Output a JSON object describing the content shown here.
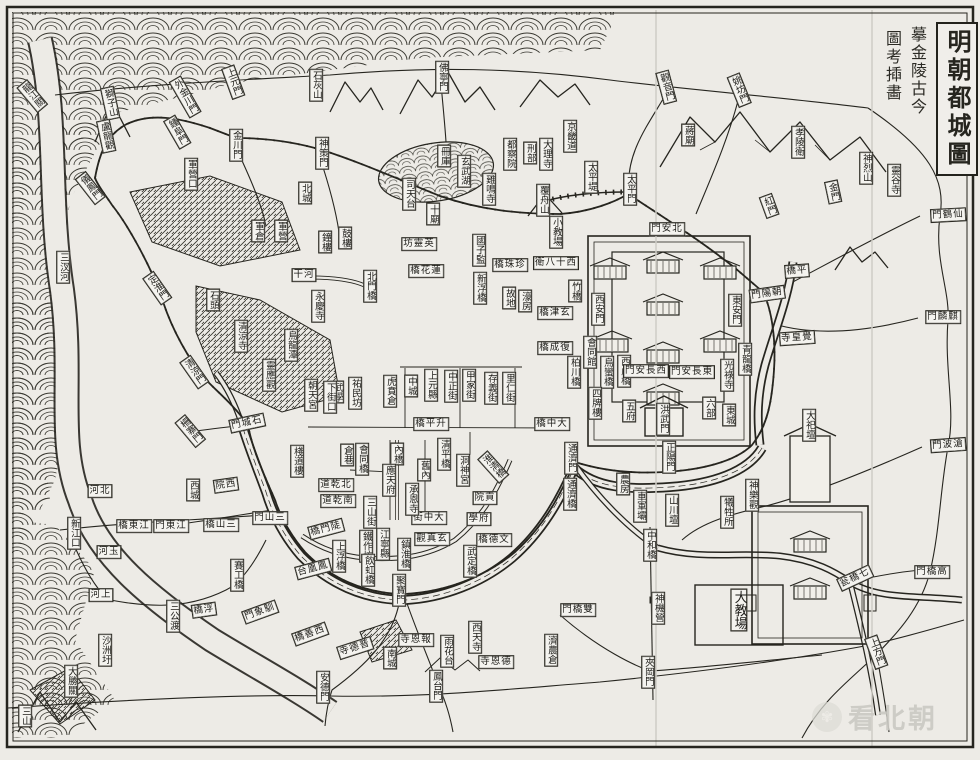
{
  "canvas": {
    "width": 980,
    "height": 760,
    "paper_color": "#edebe6",
    "ink_color": "#26251f",
    "label_bg": "#f4f3ef"
  },
  "title": {
    "main": "明朝都城圖",
    "note_right": "摹金陵古今",
    "note_left": "圖考揷畵"
  },
  "watermark": {
    "brand": "看北朝",
    "badge_icon": "hand-logo"
  },
  "labels": [
    {
      "t": "龍江關",
      "x": 32,
      "y": 96,
      "o": "v",
      "r": -40
    },
    {
      "t": "獅子山",
      "x": 110,
      "y": 103,
      "o": "v",
      "r": -12
    },
    {
      "t": "盧龍觀",
      "x": 106,
      "y": 136,
      "o": "v",
      "r": -12
    },
    {
      "t": "外金川門",
      "x": 185,
      "y": 97,
      "o": "v",
      "r": -30
    },
    {
      "t": "鍾阜門",
      "x": 177,
      "y": 132,
      "o": "v",
      "r": -30
    },
    {
      "t": "儀鳳門",
      "x": 90,
      "y": 188,
      "o": "v",
      "r": -38
    },
    {
      "t": "上元門",
      "x": 233,
      "y": 82,
      "o": "v",
      "r": -20
    },
    {
      "t": "金川門",
      "x": 236,
      "y": 145,
      "o": "v",
      "r": 0
    },
    {
      "t": "軍營口",
      "x": 191,
      "y": 174,
      "o": "v",
      "r": 0
    },
    {
      "t": "石灰山",
      "x": 316,
      "y": 85,
      "o": "v",
      "r": 0
    },
    {
      "t": "神策門",
      "x": 322,
      "y": 153,
      "o": "v",
      "r": 0
    },
    {
      "t": "佛寧門",
      "x": 442,
      "y": 77,
      "o": "v",
      "r": 0
    },
    {
      "t": "觀音門",
      "x": 666,
      "y": 87,
      "o": "v",
      "r": -15
    },
    {
      "t": "姚坊門",
      "x": 739,
      "y": 90,
      "o": "v",
      "r": -22
    },
    {
      "t": "蔣廟",
      "x": 688,
      "y": 135,
      "o": "v",
      "r": 0
    },
    {
      "t": "孝陵衛",
      "x": 798,
      "y": 142,
      "o": "v",
      "r": 0
    },
    {
      "t": "神烈山",
      "x": 866,
      "y": 168,
      "o": "v",
      "r": 0
    },
    {
      "t": "靈谷寺",
      "x": 894,
      "y": 180,
      "o": "v",
      "r": 0
    },
    {
      "t": "金門",
      "x": 833,
      "y": 192,
      "o": "v",
      "r": -12
    },
    {
      "t": "紅門",
      "x": 769,
      "y": 206,
      "o": "v",
      "r": -20
    },
    {
      "t": "太平門",
      "x": 630,
      "y": 189,
      "o": "v",
      "r": 0
    },
    {
      "t": "太平堤",
      "x": 591,
      "y": 177,
      "o": "v",
      "r": 0
    },
    {
      "t": "門鶴仙",
      "x": 948,
      "y": 215,
      "o": "h",
      "r": -3
    },
    {
      "t": "門麟麒",
      "x": 943,
      "y": 317,
      "o": "h",
      "r": 0
    },
    {
      "t": "門波滄",
      "x": 948,
      "y": 445,
      "o": "h",
      "r": -4
    },
    {
      "t": "北城",
      "x": 305,
      "y": 193,
      "o": "v",
      "r": 0
    },
    {
      "t": "軍倉",
      "x": 258,
      "y": 231,
      "o": "v",
      "r": 0
    },
    {
      "t": "軍營",
      "x": 281,
      "y": 231,
      "o": "v",
      "r": 0
    },
    {
      "t": "鐘樓",
      "x": 325,
      "y": 242,
      "o": "v",
      "r": 0
    },
    {
      "t": "鼓樓",
      "x": 345,
      "y": 238,
      "o": "v",
      "r": 0
    },
    {
      "t": "冊庫",
      "x": 444,
      "y": 156,
      "o": "v",
      "r": 0
    },
    {
      "t": "玄武湖",
      "x": 464,
      "y": 171,
      "o": "v",
      "r": 0
    },
    {
      "t": "司天台",
      "x": 409,
      "y": 194,
      "o": "v",
      "r": 0
    },
    {
      "t": "十廟",
      "x": 433,
      "y": 214,
      "o": "v",
      "r": 0
    },
    {
      "t": "雞鳴寺",
      "x": 489,
      "y": 189,
      "o": "v",
      "r": 0
    },
    {
      "t": "覆舟山",
      "x": 543,
      "y": 200,
      "o": "v",
      "r": 0
    },
    {
      "t": "京畿道",
      "x": 570,
      "y": 136,
      "o": "v",
      "r": 0
    },
    {
      "t": "都察院",
      "x": 510,
      "y": 154,
      "o": "v",
      "r": 0
    },
    {
      "t": "刑部",
      "x": 530,
      "y": 153,
      "o": "v",
      "r": 0
    },
    {
      "t": "大理寺",
      "x": 546,
      "y": 154,
      "o": "v",
      "r": 0
    },
    {
      "t": "小教場",
      "x": 556,
      "y": 232,
      "o": "v",
      "r": 0
    },
    {
      "t": "國子監",
      "x": 479,
      "y": 250,
      "o": "v",
      "r": 0
    },
    {
      "t": "坊靈英",
      "x": 419,
      "y": 244,
      "o": "h",
      "r": 0
    },
    {
      "t": "橋珠珍",
      "x": 510,
      "y": 265,
      "o": "h",
      "r": 0
    },
    {
      "t": "衛八十西",
      "x": 556,
      "y": 263,
      "o": "h",
      "r": 0
    },
    {
      "t": "橋花蓮",
      "x": 426,
      "y": 271,
      "o": "h",
      "r": 0
    },
    {
      "t": "新浮橋",
      "x": 480,
      "y": 288,
      "o": "v",
      "r": 0
    },
    {
      "t": "竹橋",
      "x": 575,
      "y": 291,
      "o": "v",
      "r": 0
    },
    {
      "t": "故地",
      "x": 509,
      "y": 298,
      "o": "v",
      "r": 0
    },
    {
      "t": "濠房",
      "x": 525,
      "y": 301,
      "o": "v",
      "r": 0
    },
    {
      "t": "橋津玄",
      "x": 555,
      "y": 313,
      "o": "h",
      "r": 0
    },
    {
      "t": "干河",
      "x": 304,
      "y": 275,
      "o": "h",
      "r": 0
    },
    {
      "t": "永慶寺",
      "x": 318,
      "y": 306,
      "o": "v",
      "r": 0
    },
    {
      "t": "北門橋",
      "x": 370,
      "y": 286,
      "o": "v",
      "r": 0
    },
    {
      "t": "定淮門",
      "x": 157,
      "y": 288,
      "o": "v",
      "r": -35
    },
    {
      "t": "石頭",
      "x": 213,
      "y": 300,
      "o": "v",
      "r": 0
    },
    {
      "t": "清涼寺",
      "x": 241,
      "y": 336,
      "o": "v",
      "r": 0
    },
    {
      "t": "烏龍潭",
      "x": 291,
      "y": 345,
      "o": "v",
      "r": 0
    },
    {
      "t": "靈應觀",
      "x": 269,
      "y": 375,
      "o": "v",
      "r": 0
    },
    {
      "t": "清涼門",
      "x": 194,
      "y": 372,
      "o": "v",
      "r": -35
    },
    {
      "t": "武學",
      "x": 337,
      "y": 392,
      "o": "v",
      "r": 0
    },
    {
      "t": "祐民坊",
      "x": 355,
      "y": 393,
      "o": "v",
      "r": 0
    },
    {
      "t": "虎賁倉",
      "x": 390,
      "y": 391,
      "o": "v",
      "r": 0
    },
    {
      "t": "朝天宮",
      "x": 311,
      "y": 395,
      "o": "v",
      "r": 0
    },
    {
      "t": "下街口",
      "x": 330,
      "y": 397,
      "o": "v",
      "r": 0
    },
    {
      "t": "門城石",
      "x": 247,
      "y": 423,
      "o": "h",
      "r": -12
    },
    {
      "t": "柵寨門",
      "x": 190,
      "y": 431,
      "o": "v",
      "r": -40
    },
    {
      "t": "西城",
      "x": 193,
      "y": 490,
      "o": "v",
      "r": 0
    },
    {
      "t": "院西",
      "x": 226,
      "y": 485,
      "o": "h",
      "r": -8
    },
    {
      "t": "倉巷",
      "x": 347,
      "y": 455,
      "o": "v",
      "r": 0
    },
    {
      "t": "棧道樓",
      "x": 297,
      "y": 461,
      "o": "v",
      "r": 0
    },
    {
      "t": "橋平升",
      "x": 431,
      "y": 424,
      "o": "h",
      "r": 0
    },
    {
      "t": "橋中大",
      "x": 552,
      "y": 424,
      "o": "h",
      "r": 0
    },
    {
      "t": "中城",
      "x": 411,
      "y": 386,
      "o": "v",
      "r": 0
    },
    {
      "t": "上元縣",
      "x": 431,
      "y": 385,
      "o": "v",
      "r": 0
    },
    {
      "t": "中正街",
      "x": 451,
      "y": 386,
      "o": "v",
      "r": 0
    },
    {
      "t": "甲家街",
      "x": 469,
      "y": 385,
      "o": "v",
      "r": 0
    },
    {
      "t": "存義街",
      "x": 491,
      "y": 388,
      "o": "v",
      "r": 0
    },
    {
      "t": "里仁街",
      "x": 509,
      "y": 388,
      "o": "v",
      "r": 0
    },
    {
      "t": "橋成復",
      "x": 555,
      "y": 348,
      "o": "h",
      "r": 0
    },
    {
      "t": "會同館",
      "x": 590,
      "y": 352,
      "o": "v",
      "r": 0
    },
    {
      "t": "柏川橋",
      "x": 574,
      "y": 372,
      "o": "v",
      "r": 0
    },
    {
      "t": "烏蠻橋",
      "x": 607,
      "y": 372,
      "o": "v",
      "r": 0
    },
    {
      "t": "四牌樓",
      "x": 595,
      "y": 403,
      "o": "v",
      "r": 0
    },
    {
      "t": "西虎橋",
      "x": 624,
      "y": 371,
      "o": "v",
      "r": 0
    },
    {
      "t": "門安長西",
      "x": 646,
      "y": 371,
      "o": "h",
      "r": 0
    },
    {
      "t": "門安長東",
      "x": 692,
      "y": 372,
      "o": "h",
      "r": 0
    },
    {
      "t": "五府",
      "x": 629,
      "y": 411,
      "o": "v",
      "r": 0
    },
    {
      "t": "六部",
      "x": 709,
      "y": 408,
      "o": "v",
      "r": 0
    },
    {
      "t": "東城",
      "x": 729,
      "y": 415,
      "o": "v",
      "r": 0
    },
    {
      "t": "洪武門",
      "x": 663,
      "y": 419,
      "o": "v",
      "r": 0
    },
    {
      "t": "光祿寺",
      "x": 727,
      "y": 375,
      "o": "v",
      "r": 0
    },
    {
      "t": "青龍橋",
      "x": 745,
      "y": 359,
      "o": "v",
      "r": 0
    },
    {
      "t": "門安北",
      "x": 667,
      "y": 229,
      "o": "h",
      "r": 0
    },
    {
      "t": "西安門",
      "x": 598,
      "y": 309,
      "o": "v",
      "r": 0
    },
    {
      "t": "東安門",
      "x": 735,
      "y": 310,
      "o": "v",
      "r": 0
    },
    {
      "t": "門陽朝",
      "x": 767,
      "y": 294,
      "o": "h",
      "r": -8
    },
    {
      "t": "橋平",
      "x": 797,
      "y": 271,
      "o": "h",
      "r": -4
    },
    {
      "t": "寺皇覺",
      "x": 797,
      "y": 338,
      "o": "h",
      "r": -4
    },
    {
      "t": "內橋",
      "x": 397,
      "y": 454,
      "o": "v",
      "r": 0
    },
    {
      "t": "會同橋",
      "x": 362,
      "y": 459,
      "o": "v",
      "r": 0
    },
    {
      "t": "應天府",
      "x": 389,
      "y": 480,
      "o": "v",
      "r": 0
    },
    {
      "t": "舊內",
      "x": 424,
      "y": 470,
      "o": "v",
      "r": 0
    },
    {
      "t": "清平橋",
      "x": 444,
      "y": 454,
      "o": "v",
      "r": 0
    },
    {
      "t": "洞神宮",
      "x": 463,
      "y": 470,
      "o": "v",
      "r": 0
    },
    {
      "t": "淮清橋",
      "x": 493,
      "y": 467,
      "o": "v",
      "r": -42
    },
    {
      "t": "道乾北",
      "x": 336,
      "y": 485,
      "o": "h",
      "r": 0
    },
    {
      "t": "道乾南",
      "x": 338,
      "y": 501,
      "o": "h",
      "r": 0
    },
    {
      "t": "街中大",
      "x": 429,
      "y": 518,
      "o": "h",
      "r": 0
    },
    {
      "t": "承恩寺",
      "x": 412,
      "y": 499,
      "o": "v",
      "r": 0
    },
    {
      "t": "觀真玄",
      "x": 432,
      "y": 539,
      "o": "h",
      "r": 0
    },
    {
      "t": "院貢",
      "x": 485,
      "y": 498,
      "o": "h",
      "r": 0
    },
    {
      "t": "學府",
      "x": 479,
      "y": 519,
      "o": "h",
      "r": 0
    },
    {
      "t": "橋德文",
      "x": 494,
      "y": 540,
      "o": "h",
      "r": 0
    },
    {
      "t": "武定橋",
      "x": 470,
      "y": 561,
      "o": "v",
      "r": 0
    },
    {
      "t": "三山街",
      "x": 370,
      "y": 512,
      "o": "v",
      "r": 0
    },
    {
      "t": "江寧縣",
      "x": 383,
      "y": 544,
      "o": "v",
      "r": 0
    },
    {
      "t": "鐵作坊",
      "x": 366,
      "y": 546,
      "o": "v",
      "r": 0
    },
    {
      "t": "飲虹橋",
      "x": 368,
      "y": 570,
      "o": "v",
      "r": 0
    },
    {
      "t": "鎮淮橋",
      "x": 404,
      "y": 554,
      "o": "v",
      "r": 0
    },
    {
      "t": "聚寶門",
      "x": 399,
      "y": 590,
      "o": "v",
      "r": 0
    },
    {
      "t": "上浮橋",
      "x": 339,
      "y": 556,
      "o": "v",
      "r": 0
    },
    {
      "t": "橋門陡",
      "x": 326,
      "y": 529,
      "o": "h",
      "r": -15
    },
    {
      "t": "台凰鳳",
      "x": 313,
      "y": 569,
      "o": "h",
      "r": -15
    },
    {
      "t": "通濟門",
      "x": 571,
      "y": 458,
      "o": "v",
      "r": 0
    },
    {
      "t": "通濟橋",
      "x": 570,
      "y": 494,
      "o": "v",
      "r": 0
    },
    {
      "t": "正陽門",
      "x": 669,
      "y": 457,
      "o": "v",
      "r": 0
    },
    {
      "t": "農房",
      "x": 623,
      "y": 484,
      "o": "v",
      "r": 0
    },
    {
      "t": "車軍壩",
      "x": 640,
      "y": 506,
      "o": "v",
      "r": 0
    },
    {
      "t": "山川壇",
      "x": 672,
      "y": 510,
      "o": "v",
      "r": 0
    },
    {
      "t": "犧牲所",
      "x": 727,
      "y": 512,
      "o": "v",
      "r": 0
    },
    {
      "t": "神樂觀",
      "x": 752,
      "y": 495,
      "o": "v",
      "r": 0
    },
    {
      "t": "大祀壇",
      "x": 809,
      "y": 425,
      "o": "v",
      "r": 0
    },
    {
      "t": "中和橋",
      "x": 650,
      "y": 545,
      "o": "v",
      "r": 0
    },
    {
      "t": "神機營",
      "x": 658,
      "y": 608,
      "o": "v",
      "r": 0
    },
    {
      "t": "大教場",
      "x": 739,
      "y": 610,
      "o": "v",
      "r": 0,
      "s": 13
    },
    {
      "t": "門橋雙",
      "x": 578,
      "y": 610,
      "o": "h",
      "r": 0
    },
    {
      "t": "濟農倉",
      "x": 551,
      "y": 650,
      "o": "v",
      "r": 0
    },
    {
      "t": "夾岡門",
      "x": 648,
      "y": 672,
      "o": "v",
      "r": 0
    },
    {
      "t": "上方門",
      "x": 876,
      "y": 652,
      "o": "v",
      "r": -20
    },
    {
      "t": "門橋高",
      "x": 932,
      "y": 572,
      "o": "h",
      "r": 0
    },
    {
      "t": "瓮橋七",
      "x": 855,
      "y": 578,
      "o": "h",
      "r": -25
    },
    {
      "t": "寺恩報",
      "x": 416,
      "y": 640,
      "o": "h",
      "r": 0
    },
    {
      "t": "雨花台",
      "x": 447,
      "y": 651,
      "o": "v",
      "r": 0
    },
    {
      "t": "西天寺",
      "x": 475,
      "y": 637,
      "o": "v",
      "r": 0
    },
    {
      "t": "寺恩德",
      "x": 496,
      "y": 662,
      "o": "h",
      "r": 0
    },
    {
      "t": "南城",
      "x": 390,
      "y": 658,
      "o": "v",
      "r": 0
    },
    {
      "t": "鳳台門",
      "x": 436,
      "y": 686,
      "o": "v",
      "r": 0
    },
    {
      "t": "安德門",
      "x": 323,
      "y": 687,
      "o": "v",
      "r": 0
    },
    {
      "t": "門象馴",
      "x": 260,
      "y": 612,
      "o": "h",
      "r": -20
    },
    {
      "t": "橋善西",
      "x": 310,
      "y": 634,
      "o": "h",
      "r": -20
    },
    {
      "t": "寺德普",
      "x": 355,
      "y": 648,
      "o": "h",
      "r": -18
    },
    {
      "t": "三汊河",
      "x": 63,
      "y": 267,
      "o": "v",
      "r": 0
    },
    {
      "t": "河北",
      "x": 100,
      "y": 491,
      "o": "h",
      "r": 0
    },
    {
      "t": "新江口",
      "x": 74,
      "y": 533,
      "o": "v",
      "r": 0
    },
    {
      "t": "河玉",
      "x": 109,
      "y": 552,
      "o": "h",
      "r": 0
    },
    {
      "t": "河上",
      "x": 101,
      "y": 595,
      "o": "h",
      "r": 0
    },
    {
      "t": "橋東江",
      "x": 134,
      "y": 526,
      "o": "h",
      "r": 0
    },
    {
      "t": "門東江",
      "x": 171,
      "y": 526,
      "o": "h",
      "r": 0
    },
    {
      "t": "橋山三",
      "x": 221,
      "y": 525,
      "o": "h",
      "r": 0
    },
    {
      "t": "門山三",
      "x": 270,
      "y": 518,
      "o": "h",
      "r": 0
    },
    {
      "t": "賽工橋",
      "x": 237,
      "y": 575,
      "o": "v",
      "r": 0
    },
    {
      "t": "橋浮",
      "x": 204,
      "y": 610,
      "o": "h",
      "r": -8
    },
    {
      "t": "三公渡",
      "x": 173,
      "y": 616,
      "o": "v",
      "r": 0
    },
    {
      "t": "沙洲圩",
      "x": 105,
      "y": 650,
      "o": "v",
      "r": 0
    },
    {
      "t": "大勝關",
      "x": 71,
      "y": 681,
      "o": "v",
      "r": 0
    },
    {
      "t": "三山",
      "x": 25,
      "y": 716,
      "o": "v",
      "r": 0
    }
  ]
}
